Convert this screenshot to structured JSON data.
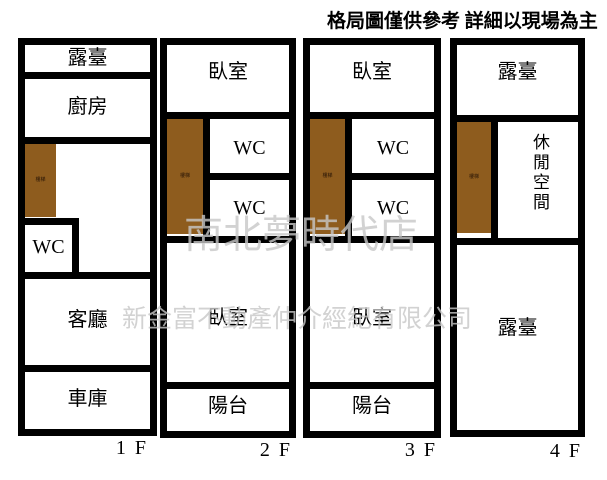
{
  "header": {
    "disclaimer": "格局圖僅供參考 詳細以現場為主"
  },
  "watermark": {
    "line1": "南北夢時代店",
    "line2": "新金富不動產仲介經紀有限公司"
  },
  "colors": {
    "wall": "#000000",
    "stairs_fill": "#8e5c1e",
    "watermark": "#c8c8c8",
    "background": "#ffffff"
  },
  "floors": [
    {
      "label": "1 F",
      "rooms": {
        "terrace": "露臺",
        "kitchen": "廚房",
        "stairs": "樓梯",
        "wc": "WC",
        "living": "客廳",
        "garage": "車庫"
      }
    },
    {
      "label": "2 F",
      "rooms": {
        "bedroom_upper": "臥室",
        "stairs": "樓梯",
        "wc_upper": "WC",
        "wc_lower": "WC",
        "bedroom_lower": "臥室",
        "balcony": "陽台"
      }
    },
    {
      "label": "3 F",
      "rooms": {
        "bedroom_upper": "臥室",
        "stairs": "樓梯",
        "wc_upper": "WC",
        "wc_lower": "WC",
        "bedroom_lower": "臥室",
        "balcony": "陽台"
      }
    },
    {
      "label": "4 F",
      "rooms": {
        "terrace_upper": "露臺",
        "stairs": "樓梯",
        "leisure": "休閒空間",
        "terrace_lower": "露臺"
      }
    }
  ]
}
